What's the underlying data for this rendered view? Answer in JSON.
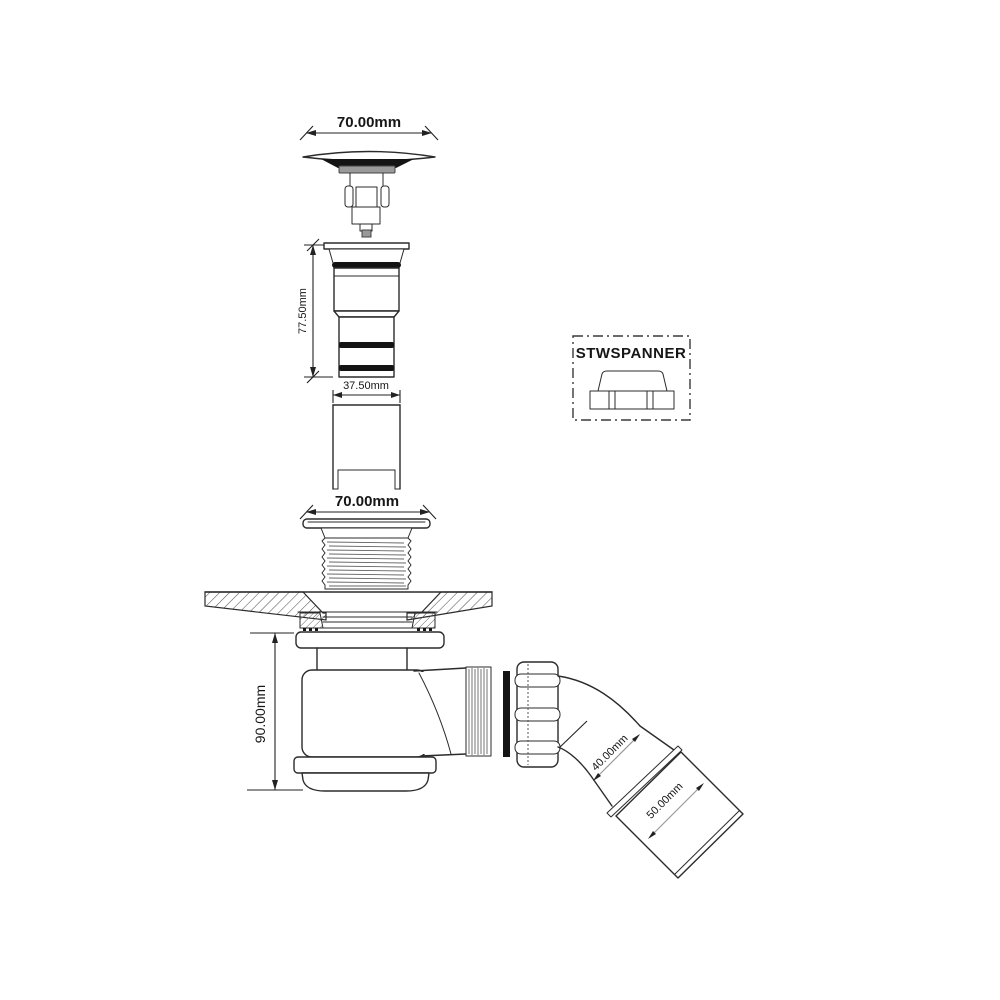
{
  "labels": {
    "dim_cap_width": "70.00mm",
    "dim_body_height": "77.50mm",
    "dim_tube_width": "37.50mm",
    "dim_flange_width": "70.00mm",
    "dim_trap_height": "90.00mm",
    "dim_elbow_inlet": "40.00mm",
    "dim_outlet": "50.00mm",
    "tool_box_label": "STWSPANNER"
  },
  "colors": {
    "line": "#2b2b2b",
    "dim": "#222222",
    "seal_black": "#141414",
    "metal_gray": "#9a9a9a",
    "hatch": "#555555",
    "background": "#ffffff"
  }
}
